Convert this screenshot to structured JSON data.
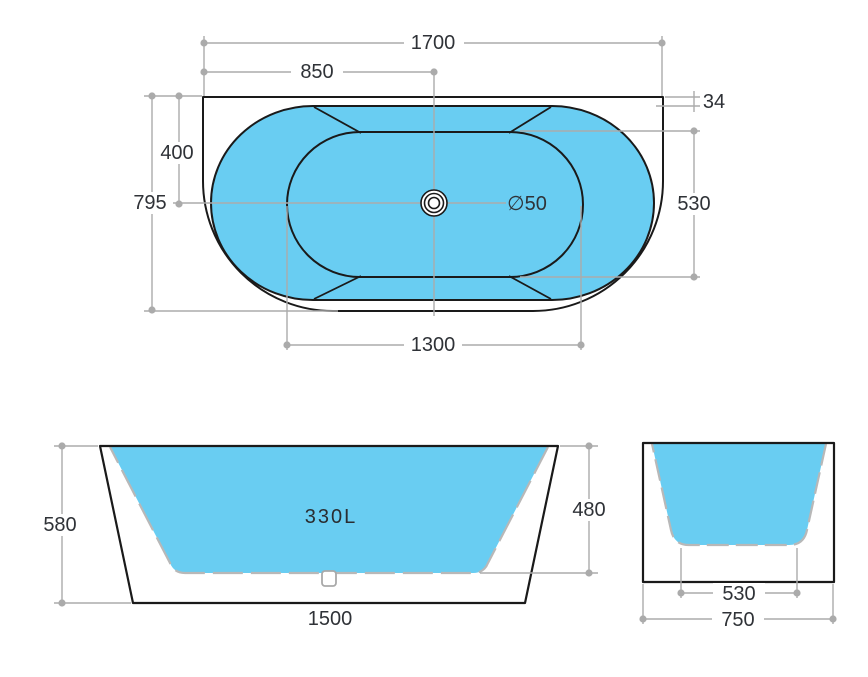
{
  "document": {
    "type": "bathtub technical drawing",
    "background": "#FFFFFF"
  },
  "colors": {
    "water_fill": "#69CDF2",
    "line": "#1A1A1A",
    "dimension_line": "#ABABAB",
    "text": "#2F3237"
  },
  "top_view": {
    "labels": {
      "overall_length": "1700",
      "center_from_left": "850",
      "rim_thickness": "34",
      "drain_from_back": "400",
      "overall_width": "795",
      "basin_width": "530",
      "basin_length": "1300",
      "drain_diameter": "∅50"
    }
  },
  "front_view": {
    "labels": {
      "overall_height": "580",
      "inner_depth": "480",
      "bottom_length": "1500",
      "capacity": "330L"
    }
  },
  "side_view": {
    "labels": {
      "bottom_width": "530",
      "overall_width": "750"
    }
  }
}
